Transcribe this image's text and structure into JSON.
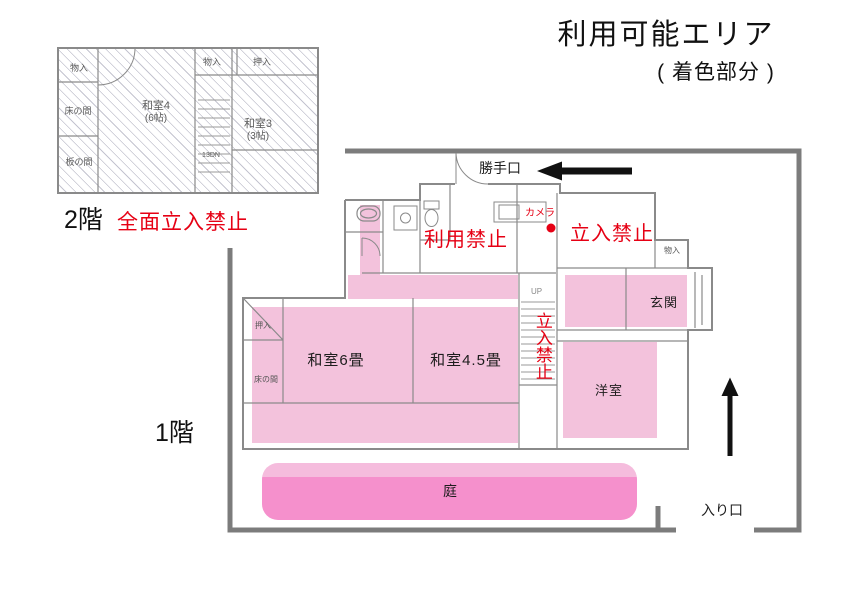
{
  "title": {
    "main": "利用可能エリア",
    "subtitle": "( 着色部分 )"
  },
  "colors": {
    "usable_pink": "#F3C2DC",
    "garden_pink": "#F590CC",
    "garden_pink_light": "#F5BCDD",
    "alert_red": "#E60014",
    "boundary_gray": "#7C7C7C",
    "plan_line_gray": "#8A8A8A"
  },
  "second_floor": {
    "floor_label": "2階",
    "restriction_label": "全面立入禁止",
    "labels": {
      "closet_top_left": "物入",
      "closet_top_center": "物入",
      "oshiire_top_right": "押入",
      "tokonoma": "床の間",
      "itanoma": "板の間",
      "washitsu4": "和室4",
      "washitsu4_size": "(6帖)",
      "washitsu3": "和室3",
      "washitsu3_size": "(3帖)",
      "stairs_note": "13DN"
    }
  },
  "first_floor": {
    "floor_label": "1階",
    "labels": {
      "back_door": "勝手口",
      "camera": "カメラ",
      "keep_out_upper": "立入禁止",
      "no_use": "利用禁止",
      "closet": "物入",
      "entrance_hall": "玄関",
      "stairs_up": "UP",
      "keep_out_stairs": "立入禁止",
      "oshiire": "押入",
      "tokonoma": "床の間",
      "washitsu_6": "和室6畳",
      "washitsu_45": "和室4.5畳",
      "western_room": "洋室",
      "garden": "庭",
      "entry": "入り口"
    }
  }
}
